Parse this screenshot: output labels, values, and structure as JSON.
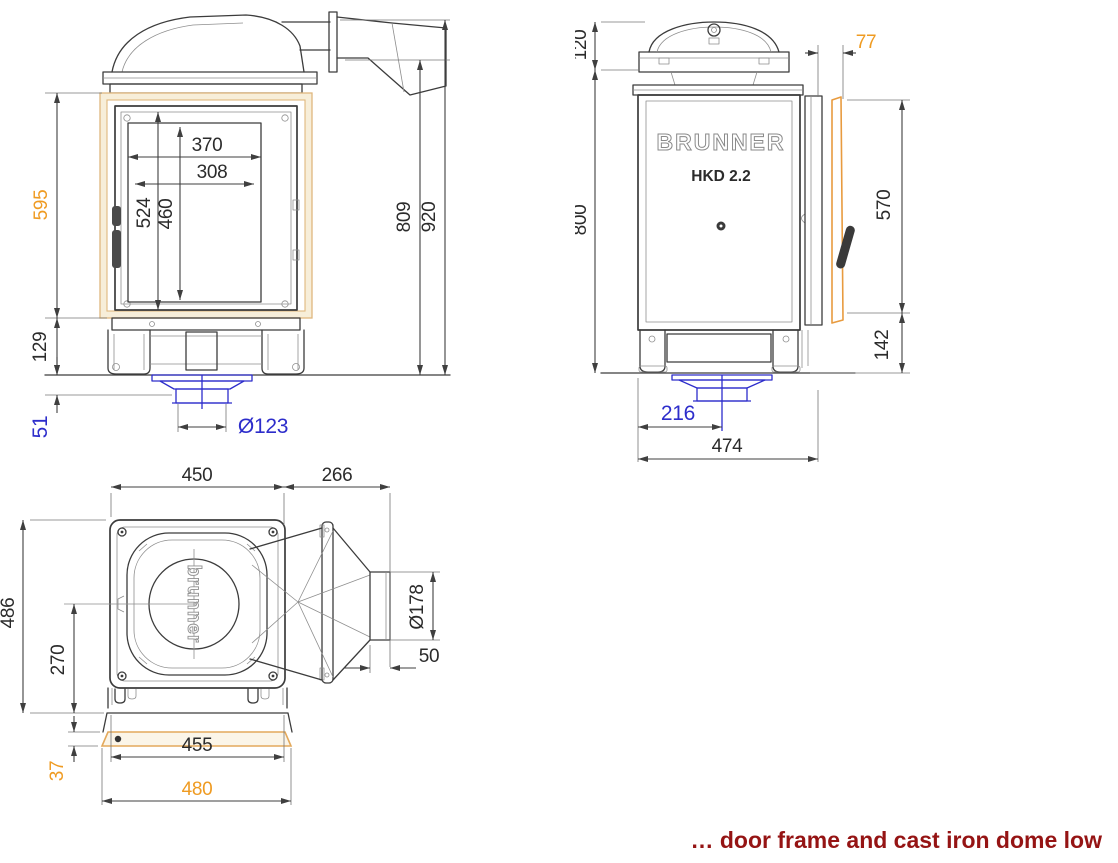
{
  "caption": {
    "text": "… door frame and cast iron dome low"
  },
  "colors": {
    "orange": "#ef9b22",
    "blue": "#2d2dcb",
    "red": "#951414",
    "line": "#3c3c3c",
    "frame_tan": "#f7eed9"
  },
  "views": {
    "front": {
      "dims": {
        "glass_width": "370",
        "glass_width_inner": "308",
        "door_opening_height": "524",
        "glass_height": "460",
        "frame_height": "595",
        "plinth_height": "129",
        "air_stub_height": "51",
        "air_diameter": "Ø123",
        "flue_underside_height": "809",
        "total_height": "920"
      }
    },
    "side": {
      "brand": "BRUNNER",
      "model": "HKD 2.2",
      "dims": {
        "dome_height": "120",
        "body_height": "800",
        "door_depth": "77",
        "door_height": "570",
        "plinth_height": "142",
        "air_center_offset": "216",
        "total_depth": "474"
      }
    },
    "top": {
      "brand": "brunner",
      "dims": {
        "body_width": "450",
        "flue_length": "266",
        "body_depth": "486",
        "flue_center_offset": "270",
        "flue_diameter": "Ø178",
        "collar_length": "50",
        "base_width": "455",
        "base_plate_height": "37",
        "base_plate_width": "480"
      }
    }
  }
}
